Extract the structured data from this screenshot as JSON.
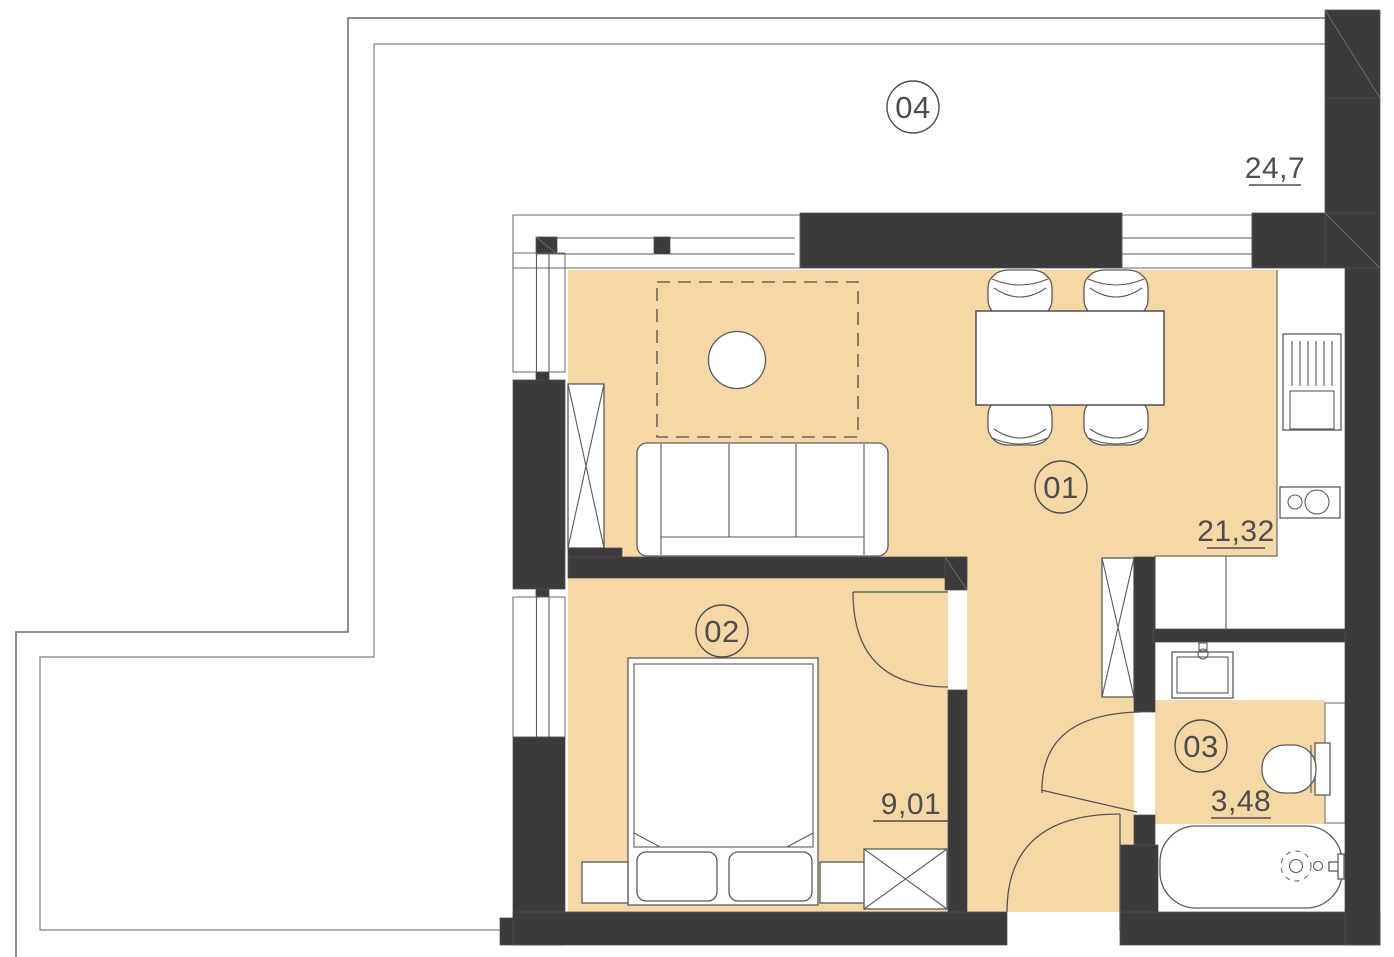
{
  "plan": {
    "rooms": [
      {
        "id": "01",
        "role": "living-room-kitchen",
        "area": "21,32"
      },
      {
        "id": "02",
        "role": "bedroom",
        "area": "9,01"
      },
      {
        "id": "03",
        "role": "bathroom",
        "area": "3,48"
      },
      {
        "id": "04",
        "role": "terrace",
        "area": "24,7"
      }
    ],
    "colors": {
      "wall": "#3b3b3d",
      "floor": "#f6d7a6",
      "line": "#58585a",
      "text": "#4d4d4f",
      "background": "#ffffff"
    }
  }
}
